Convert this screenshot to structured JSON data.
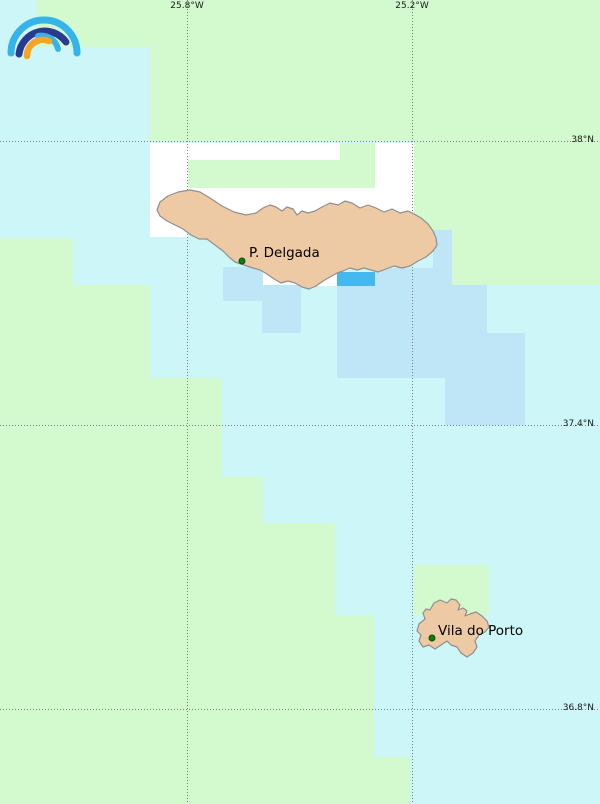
{
  "map": {
    "width": 600,
    "height": 804,
    "colors": {
      "ocean": "#cdf6f8",
      "green": "#d3f9ce",
      "white": "#ffffff",
      "light_blue": "#bfe6f6",
      "bright_blue": "#45b8ef",
      "island_fill": "#edcaa4",
      "island_border": "#8f8f8f",
      "grid_line": "#7d7d7d",
      "label_color": "#1a1a1a",
      "city_dot": "#0f7d0f",
      "city_dot_ring": "#075207"
    },
    "tiles": [
      {
        "x": 37,
        "y": 0,
        "w": 563,
        "h": 47,
        "c": "green"
      },
      {
        "x": 150,
        "y": 47,
        "w": 450,
        "h": 94,
        "c": "green"
      },
      {
        "x": 414,
        "y": 141,
        "w": 186,
        "h": 89,
        "c": "green"
      },
      {
        "x": 450,
        "y": 230,
        "w": 150,
        "h": 55,
        "c": "green"
      },
      {
        "x": 0,
        "y": 238,
        "w": 73,
        "h": 67,
        "c": "green"
      },
      {
        "x": 0,
        "y": 285,
        "w": 150,
        "h": 93,
        "c": "green"
      },
      {
        "x": 0,
        "y": 378,
        "w": 222,
        "h": 99,
        "c": "green"
      },
      {
        "x": 0,
        "y": 477,
        "w": 263,
        "h": 46,
        "c": "green"
      },
      {
        "x": 0,
        "y": 523,
        "w": 335,
        "h": 92,
        "c": "green"
      },
      {
        "x": 0,
        "y": 615,
        "w": 374,
        "h": 142,
        "c": "green"
      },
      {
        "x": 0,
        "y": 757,
        "w": 410,
        "h": 47,
        "c": "green"
      },
      {
        "x": 414,
        "y": 565,
        "w": 75,
        "h": 50,
        "c": "green"
      },
      {
        "x": 150,
        "y": 143,
        "w": 264,
        "h": 47,
        "c": "white"
      },
      {
        "x": 150,
        "y": 190,
        "w": 38,
        "h": 47,
        "c": "white"
      },
      {
        "x": 375,
        "y": 188,
        "w": 39,
        "h": 24,
        "c": "white"
      },
      {
        "x": 263,
        "y": 263,
        "w": 74,
        "h": 23,
        "c": "white"
      },
      {
        "x": 188,
        "y": 188,
        "w": 187,
        "h": 27,
        "c": "white"
      },
      {
        "x": 188,
        "y": 160,
        "w": 152,
        "h": 28,
        "c": "green"
      },
      {
        "x": 340,
        "y": 143,
        "w": 35,
        "h": 45,
        "c": "green"
      },
      {
        "x": 223,
        "y": 267,
        "w": 40,
        "h": 34,
        "c": "light_blue"
      },
      {
        "x": 262,
        "y": 285,
        "w": 39,
        "h": 48,
        "c": "light_blue"
      },
      {
        "x": 337,
        "y": 285,
        "w": 150,
        "h": 48,
        "c": "light_blue"
      },
      {
        "x": 337,
        "y": 333,
        "w": 188,
        "h": 45,
        "c": "light_blue"
      },
      {
        "x": 445,
        "y": 378,
        "w": 80,
        "h": 47,
        "c": "light_blue"
      },
      {
        "x": 375,
        "y": 268,
        "w": 77,
        "h": 18,
        "c": "light_blue"
      },
      {
        "x": 433,
        "y": 230,
        "w": 19,
        "h": 40,
        "c": "light_blue"
      },
      {
        "x": 337,
        "y": 272,
        "w": 38,
        "h": 14,
        "c": "bright_blue"
      }
    ],
    "grid": {
      "meridians": [
        {
          "x": 187,
          "label": "25.8°W"
        },
        {
          "x": 412,
          "label": "25.2°W"
        }
      ],
      "parallels": [
        {
          "y": 141,
          "label": "38°N"
        },
        {
          "y": 425,
          "label": "37.4°N"
        },
        {
          "y": 709,
          "label": "36.8°N"
        }
      ]
    },
    "islands": [
      {
        "name": "sao-miguel",
        "points": "157,210 160,202 168,196 178,192 190,190 200,192 210,198 222,206 234,212 246,215 256,213 263,208 270,205 276,207 282,211 287,207 293,209 297,215 302,211 308,213 315,211 322,207 330,203 338,205 345,201 352,203 360,208 368,205 376,208 384,212 392,209 400,213 408,211 414,214 421,218 428,224 433,231 436,238 437,245 433,251 426,257 418,261 410,266 402,268 394,266 386,269 378,272 371,270 364,268 357,270 350,268 343,271 337,273 330,277 323,281 316,286 309,289 302,287 295,283 288,281 281,283 274,279 267,274 260,270 253,268 247,266 241,264 235,262 229,257 223,251 215,245 207,239 199,239 191,235 183,229 175,225 167,221 160,216"
      },
      {
        "name": "santa-maria",
        "points": "430,610 434,603 440,600 447,603 451,599 456,600 460,605 458,610 463,608 467,611 465,616 470,614 476,612 482,616 487,621 489,627 485,632 479,635 475,641 477,647 473,653 467,657 461,653 457,647 451,645 447,641 441,645 435,649 429,645 423,647 419,641 421,635 417,631 419,624 425,619 423,613 426,609"
      }
    ],
    "cities": [
      {
        "name": "P. Delgada",
        "x": 242,
        "y": 261,
        "label_dx": 7,
        "label_dy": -16
      },
      {
        "name": "Vila do Porto",
        "x": 432,
        "y": 638,
        "label_dx": 6,
        "label_dy": -15
      }
    ],
    "logo": {
      "name": "rainbow-logo",
      "outer_color": "#35b4e9",
      "dark_color": "#2a3a8e",
      "inner_color": "#35b4e9",
      "orange_color": "#f7a423"
    }
  }
}
